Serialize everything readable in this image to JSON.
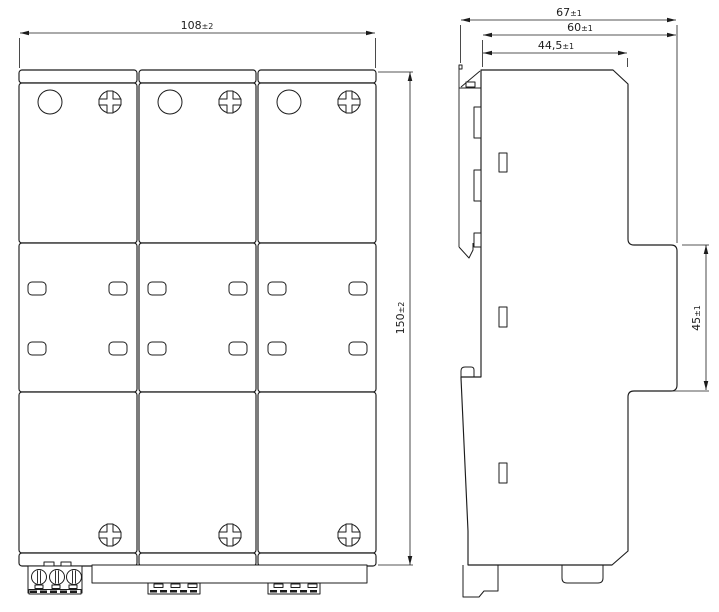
{
  "colors": {
    "line": "#1c1c1c",
    "background": "#ffffff"
  },
  "front_view": {
    "width": {
      "value": "108",
      "tolerance": "±2"
    },
    "height": {
      "value": "150",
      "tolerance": "±2"
    }
  },
  "side_view": {
    "total_depth": {
      "value": "67",
      "tolerance": "±1"
    },
    "body_depth": {
      "value": "60",
      "tolerance": "±1"
    },
    "front_depth": {
      "value": "44,5",
      "tolerance": "±1"
    },
    "rail_recess_height": {
      "value": "45",
      "tolerance": "±1"
    }
  }
}
